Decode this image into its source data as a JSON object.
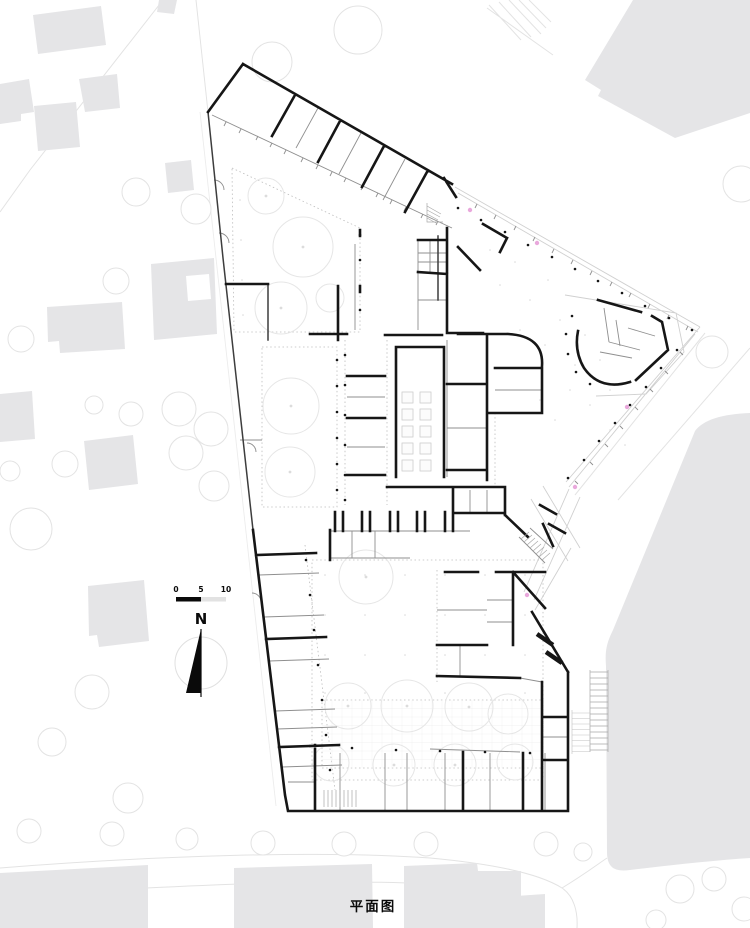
{
  "caption": "平面图",
  "scale_bar": {
    "labels": [
      "0",
      "5",
      "10"
    ]
  },
  "north_arrow": {
    "label": "N"
  },
  "colors": {
    "paper": "#ffffff",
    "wall": "#161616",
    "wall_medium": "#3d3d3d",
    "wall_light": "#8f8f8f",
    "canopy": "#d0d0d0",
    "context_building": "#e5e5e7",
    "site_line": "#e3e3e3",
    "courtyard_tree": "#e6e6e6",
    "furniture": "#cccccc",
    "accent_pink": "#e9a8dc"
  }
}
